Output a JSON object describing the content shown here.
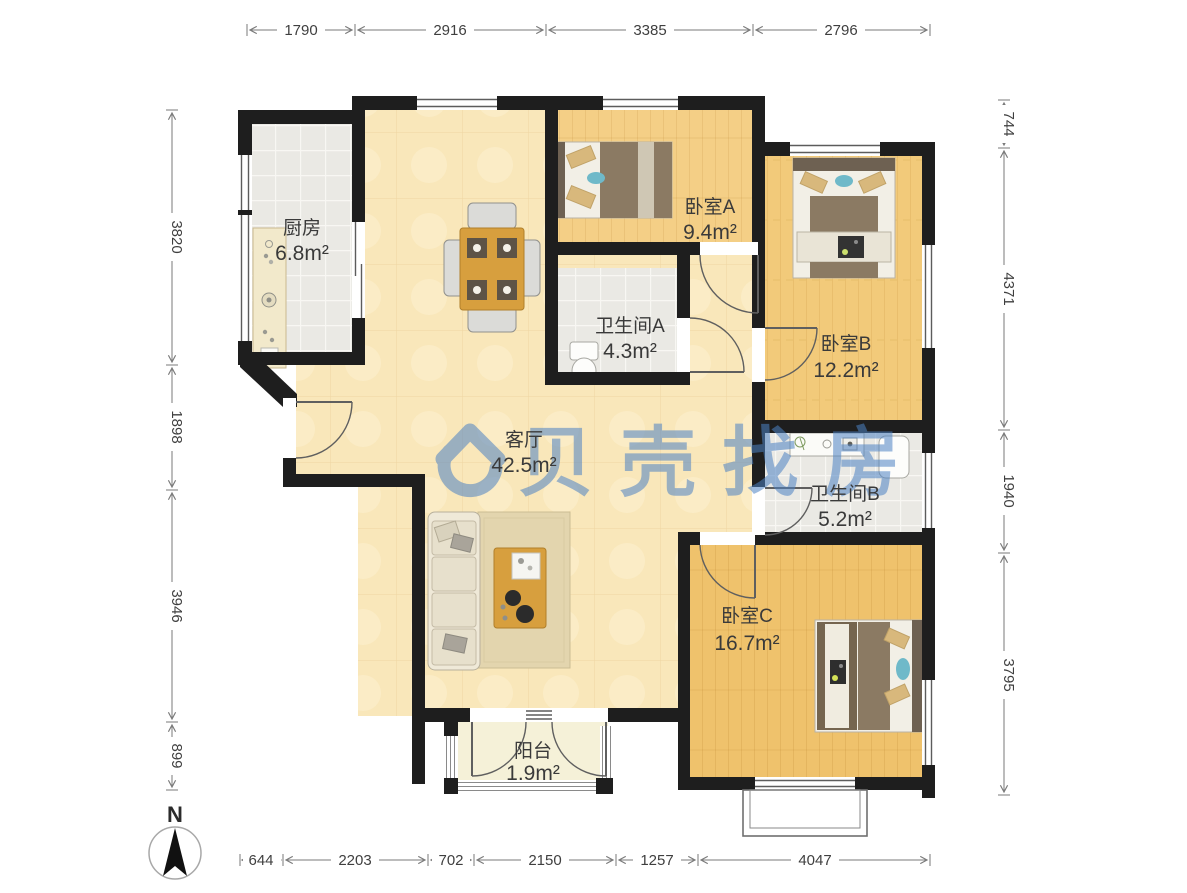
{
  "rooms": {
    "kitchen": {
      "name": "厨房",
      "area": "6.8m²"
    },
    "bedroom_a": {
      "name": "卧室A",
      "area": "9.4m²"
    },
    "bedroom_b": {
      "name": "卧室B",
      "area": "12.2m²"
    },
    "bath_a": {
      "name": "卫生间A",
      "area": "4.3m²"
    },
    "living": {
      "name": "客厅",
      "area": "42.5m²"
    },
    "bath_b": {
      "name": "卫生间B",
      "area": "5.2m²"
    },
    "bedroom_c": {
      "name": "卧室C",
      "area": "16.7m²"
    },
    "balcony": {
      "name": "阳台",
      "area": "1.9m²"
    }
  },
  "dimensions_mm": {
    "top": [
      "1790",
      "2916",
      "3385",
      "2796"
    ],
    "left": [
      "3820",
      "1898",
      "3946",
      "899"
    ],
    "right": [
      "744",
      "4371",
      "1940",
      "3795"
    ],
    "bottom": [
      "644",
      "2203",
      "702",
      "2150",
      "1257",
      "4047"
    ]
  },
  "compass": {
    "north_label": "N"
  },
  "watermark": {
    "brand_text": "贝壳找房",
    "accent_color": "#4d82c4"
  },
  "palette": {
    "wall": "#1e1e1e",
    "living_floor": "#f9e7ba",
    "bedroom_floor": "#f2cb7c",
    "tile_floor": "#eae9e4",
    "balcony_floor": "#f5f1d8"
  }
}
